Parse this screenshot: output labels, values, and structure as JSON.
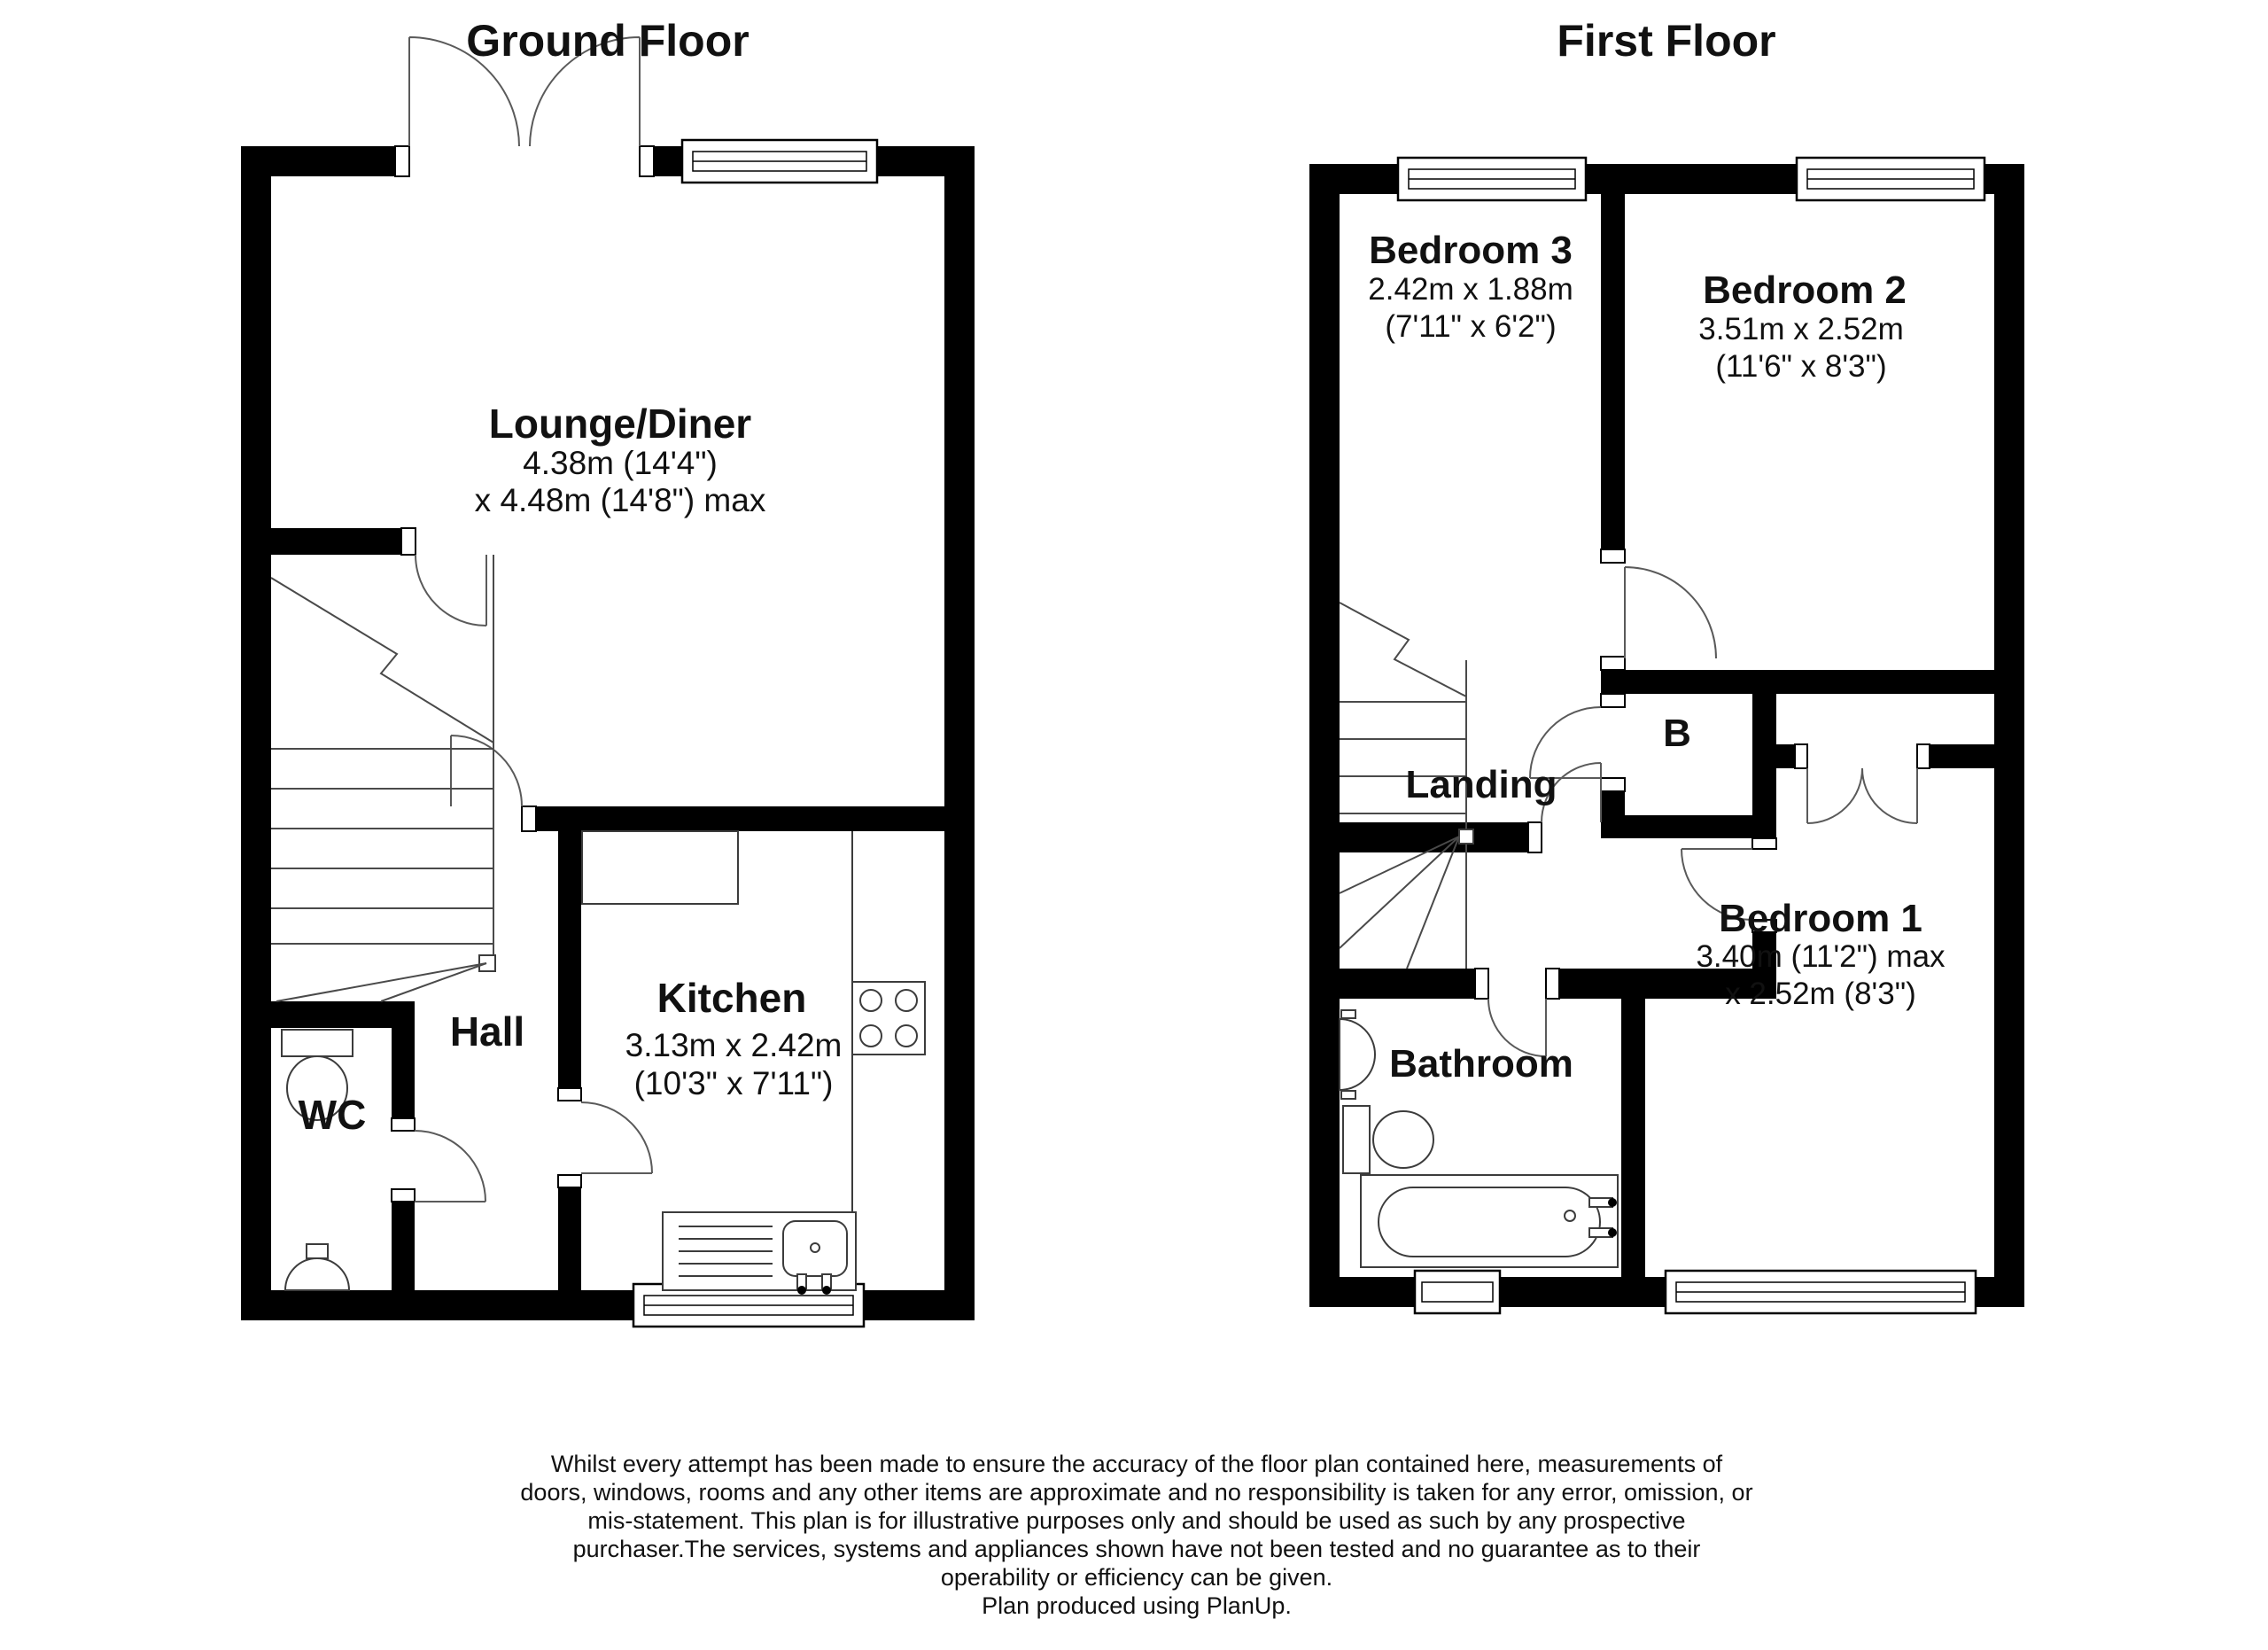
{
  "ground_floor": {
    "title": "Ground Floor",
    "rooms": {
      "lounge": {
        "name": "Lounge/Diner",
        "dim1": "4.38m (14'4\")",
        "dim2": "x 4.48m (14'8\") max"
      },
      "kitchen": {
        "name": "Kitchen",
        "dim1": "3.13m x 2.42m",
        "dim2": "(10'3\" x 7'11\")"
      },
      "hall": {
        "name": "Hall"
      },
      "wc": {
        "name": "WC"
      }
    }
  },
  "first_floor": {
    "title": "First Floor",
    "rooms": {
      "bedroom3": {
        "name": "Bedroom 3",
        "dim1": "2.42m x 1.88m",
        "dim2": "(7'11\" x 6'2\")"
      },
      "bedroom2": {
        "name": "Bedroom 2",
        "dim1": "3.51m x 2.52m",
        "dim2": "(11'6\" x 8'3\")"
      },
      "bedroom1": {
        "name": "Bedroom 1",
        "dim1": "3.40m (11'2\") max",
        "dim2": "x 2.52m (8'3\")"
      },
      "landing": {
        "name": "Landing"
      },
      "cupboard": {
        "name": "B"
      },
      "bathroom": {
        "name": "Bathroom"
      }
    }
  },
  "disclaimer": {
    "lines": [
      "Whilst every attempt has been made to ensure the accuracy of the floor plan contained here, measurements of",
      "doors, windows, rooms and any other items are approximate and no responsibility is taken for any error, omission, or",
      "mis-statement. This plan is for illustrative purposes only and should be used as such by any prospective",
      "purchaser.The services, systems and appliances shown have not been tested and no guarantee as to their",
      "operability or efficiency can be given.",
      "Plan produced using PlanUp."
    ]
  },
  "colors": {
    "wall": "#000000",
    "background": "#ffffff",
    "line": "#4a4a4a"
  }
}
